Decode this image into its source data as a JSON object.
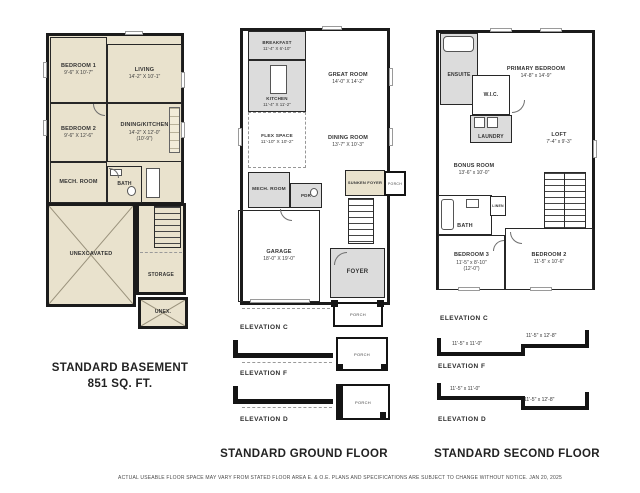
{
  "page": {
    "disclaimer": "ACTUAL USEABLE FLOOR SPACE MAY VARY FROM STATED FLOOR AREA E. & O.E. PLANS AND SPECIFICATIONS ARE SUBJECT TO CHANGE WITHOUT NOTICE. JAN 20, 2025"
  },
  "colors": {
    "wall": "#1b1b1b",
    "basement_fill": "#e9e2cd",
    "service_fill": "#dcdcdc",
    "background": "#ffffff"
  },
  "basement": {
    "title": "STANDARD BASEMENT",
    "area": "851 SQ. FT.",
    "rooms": {
      "bedroom1": {
        "name": "BEDROOM 1",
        "dims": "9'-6\" X 10'-7\""
      },
      "living": {
        "name": "LIVING",
        "dims": "14'-2\" X 10'-1\""
      },
      "bedroom2": {
        "name": "BEDROOM 2",
        "dims": "9'-6\" X 12'-6\""
      },
      "dining_kitchen": {
        "name": "DINING/KITCHEN",
        "dims": "14'-2\" X 12'-0\"",
        "dims2": "(10'-9\")"
      },
      "mech": {
        "name": "MECH. ROOM"
      },
      "bath": {
        "name": "BATH"
      },
      "unexcavated": {
        "name": "UNEXCAVATED"
      },
      "storage": {
        "name": "STORAGE"
      },
      "unex": {
        "name": "UNEX."
      }
    }
  },
  "ground": {
    "title": "STANDARD GROUND FLOOR",
    "rooms": {
      "breakfast": {
        "name": "BREAKFAST",
        "dims": "11'-4\" X 6'-10\""
      },
      "kitchen": {
        "name": "KITCHEN",
        "dims": "11'-4\" X 11'-2\""
      },
      "great_room": {
        "name": "GREAT ROOM",
        "dims": "14'-0\" X 14'-2\""
      },
      "flex_space": {
        "name": "FLEX SPACE",
        "dims": "11'-10\" X 10'-2\""
      },
      "dining_room": {
        "name": "DINING ROOM",
        "dims": "13'-7\" X 10'-3\""
      },
      "mech": {
        "name": "MECH. ROOM"
      },
      "pdr": {
        "name": "PDR"
      },
      "sunken_foyer": {
        "name": "SUNKEN FOYER"
      },
      "garage": {
        "name": "GARAGE",
        "dims": "18'-0\" X 19'-0\""
      },
      "foyer": {
        "name": "FOYER"
      },
      "porch": {
        "name": "PORCH"
      }
    },
    "elevations": [
      {
        "label": "ELEVATION C",
        "porch": "PORCH"
      },
      {
        "label": "ELEVATION F",
        "porch": "PORCH"
      },
      {
        "label": "ELEVATION D",
        "porch": "PORCH"
      }
    ]
  },
  "second": {
    "title": "STANDARD SECOND FLOOR",
    "rooms": {
      "ensuite": {
        "name": "ENSUITE"
      },
      "primary_bedroom": {
        "name": "PRIMARY BEDROOM",
        "dims": "14'-8\" x 14'-9\""
      },
      "wic": {
        "name": "W.I.C."
      },
      "laundry": {
        "name": "LAUNDRY"
      },
      "loft": {
        "name": "LOFT",
        "dims": "7'-4\" x 9'-3\""
      },
      "bonus_room": {
        "name": "BONUS ROOM",
        "dims": "13'-6\" x 10'-0\""
      },
      "bath": {
        "name": "BATH"
      },
      "linen": {
        "name": "LINEN"
      },
      "bedroom3": {
        "name": "BEDROOM 3",
        "dims": "11'-5\" x 8'-10\"",
        "dims2": "(12'-0\")"
      },
      "bedroom2": {
        "name": "BEDROOM 2",
        "dims": "11'-5\" x 10'-6\""
      }
    },
    "elevations": [
      {
        "label": "ELEVATION C"
      },
      {
        "label": "ELEVATION F",
        "dim_left": "11'-5\" x 11'-0\"",
        "dim_right": "11'-5\" x 12'-8\""
      },
      {
        "label": "ELEVATION D",
        "dim_left": "11'-5\" x 11'-0\"",
        "dim_right": "11'-5\" x 12'-8\""
      }
    ]
  }
}
